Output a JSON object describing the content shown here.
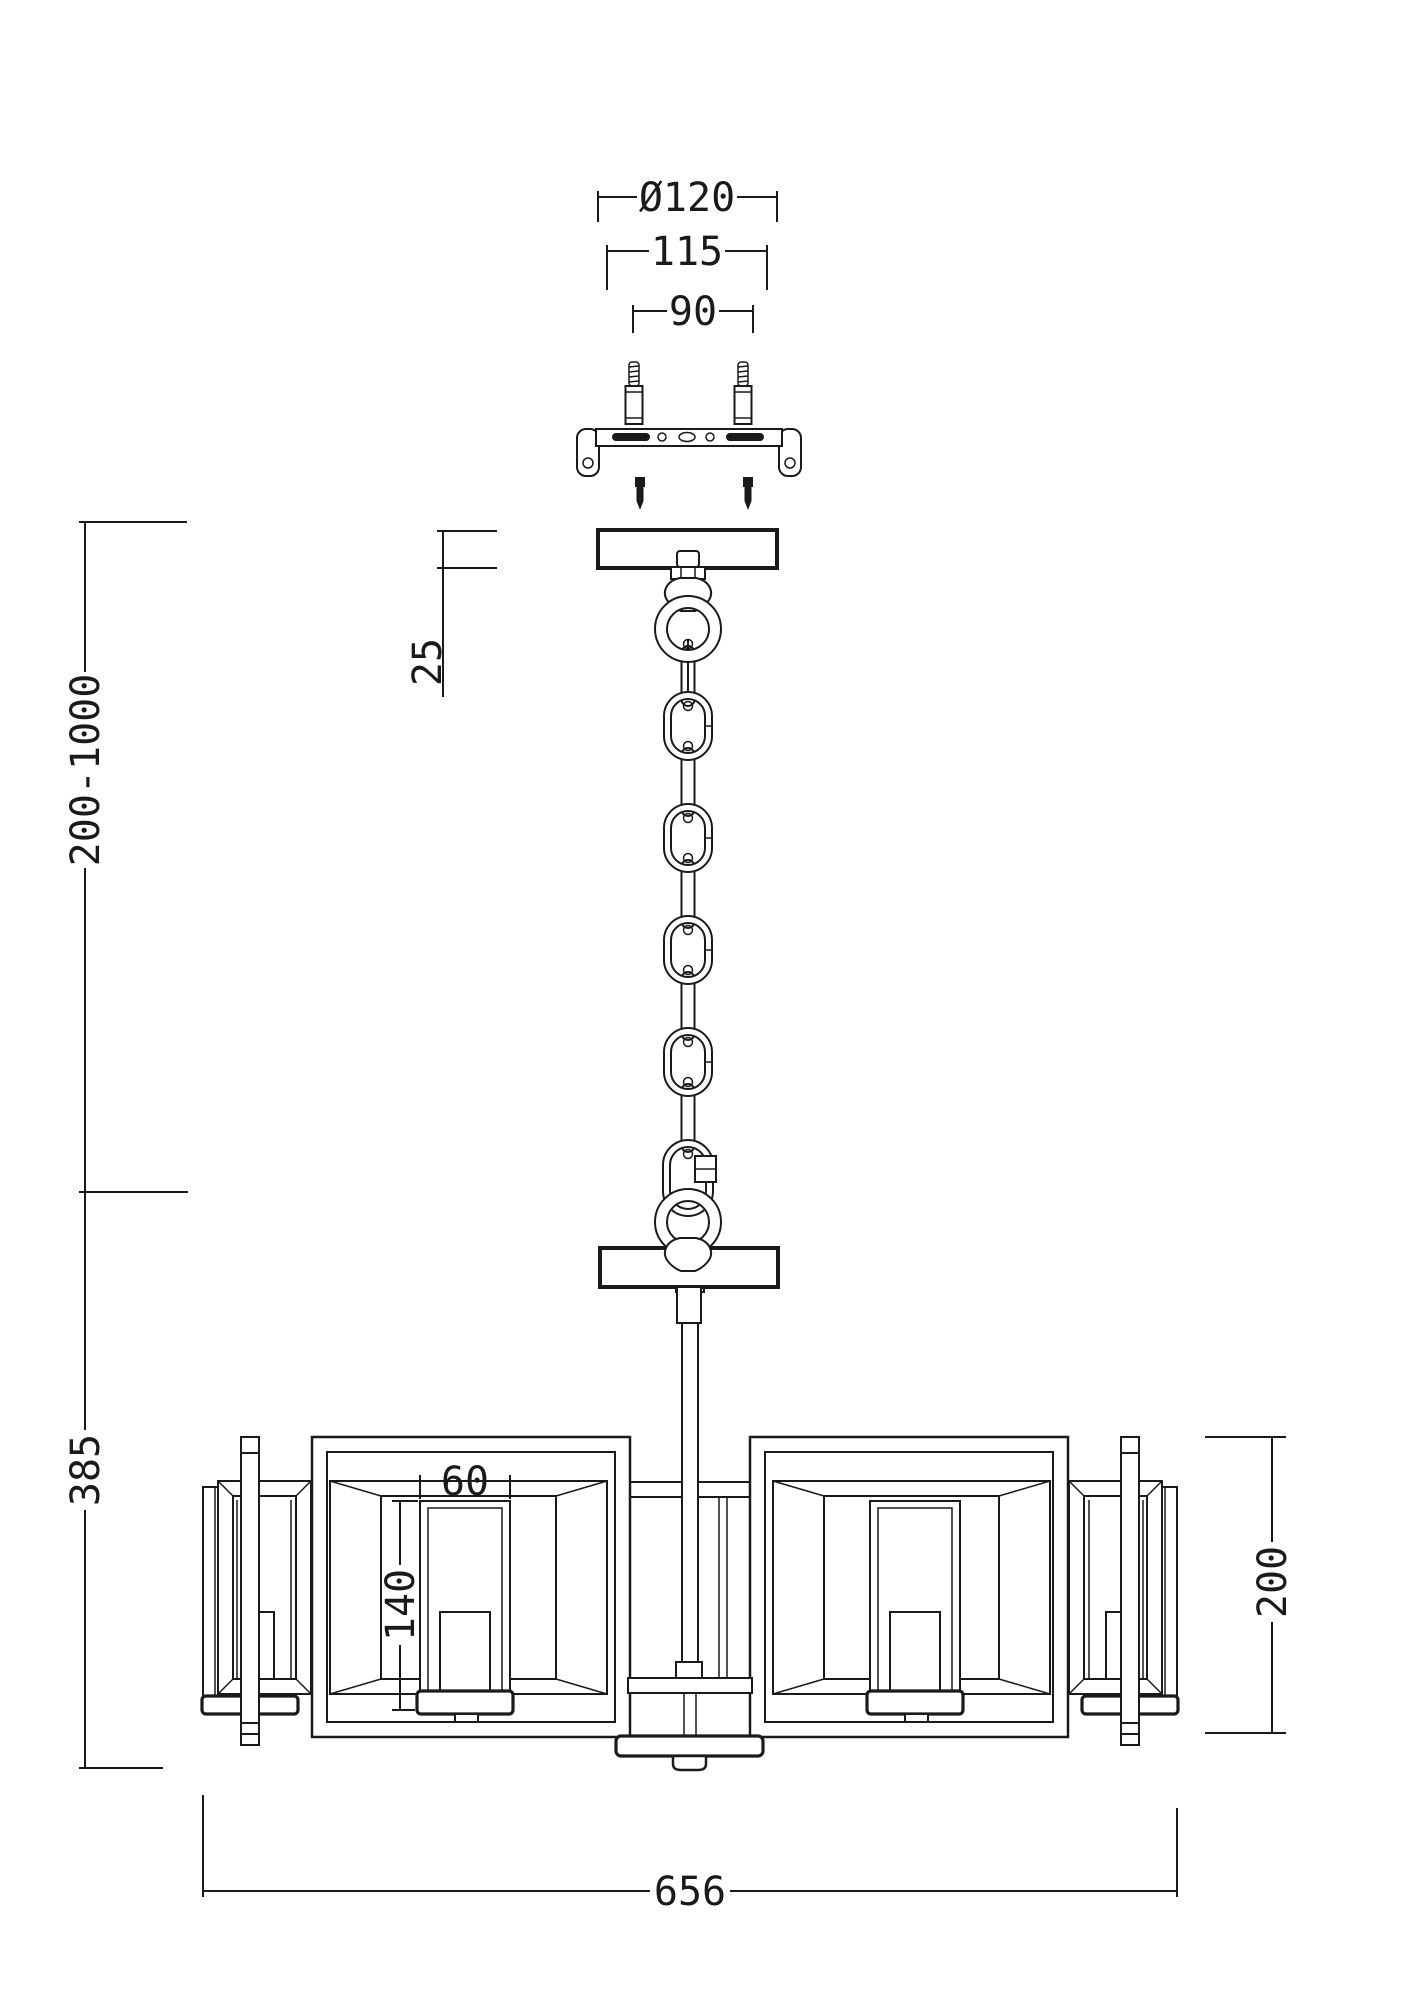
{
  "drawing": {
    "type": "technical-installation-diagram",
    "line_color": "#1a1a1a",
    "background": "#ffffff",
    "dimensions": {
      "mount_diameter": "Ø120",
      "plate_width": "115",
      "screw_spacing": "90",
      "canopy_height": "25",
      "suspension_range": "200-1000",
      "body_height": "385",
      "shade_width": "60",
      "shade_height": "140",
      "drum_height": "200",
      "total_width": "656"
    }
  }
}
